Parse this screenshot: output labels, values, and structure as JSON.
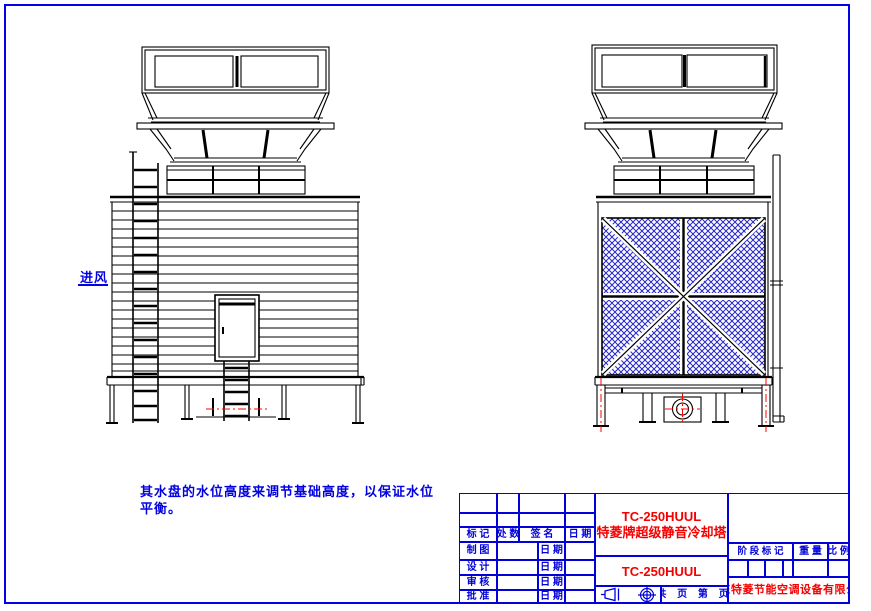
{
  "page": {
    "background": "#ffffff",
    "border_color": "#0202e8"
  },
  "colors": {
    "drawing_line": "#000000",
    "annotation_blue": "#0202e0",
    "annotation_red": "#ff0000",
    "mesh_blue": "#2525cf"
  },
  "drawing": {
    "air_inlet_label": "进风",
    "note_line1": "其水盘的水位高度来调节基础高度，以保证水位",
    "note_line2": "平衡。"
  },
  "title_block": {
    "model": "TC-250HUUL",
    "product_name": "特菱牌超级静音冷却塔",
    "drawing_number": "TC-250HUUL",
    "company": "广东特菱节能空调设备有限公司",
    "pages_label": "共 页 第 页",
    "col_mark": "标 记",
    "col_count": "处 数",
    "col_signature": "签 名",
    "col_date": "日 期",
    "row_draft": "制 图",
    "row_design": "设 计",
    "row_review": "审 核",
    "row_approve": "批 准",
    "date_label": "日 期",
    "stage_mark_label": "阶 段 标 记",
    "weight_label": "重 量",
    "scale_label": "比 例"
  }
}
